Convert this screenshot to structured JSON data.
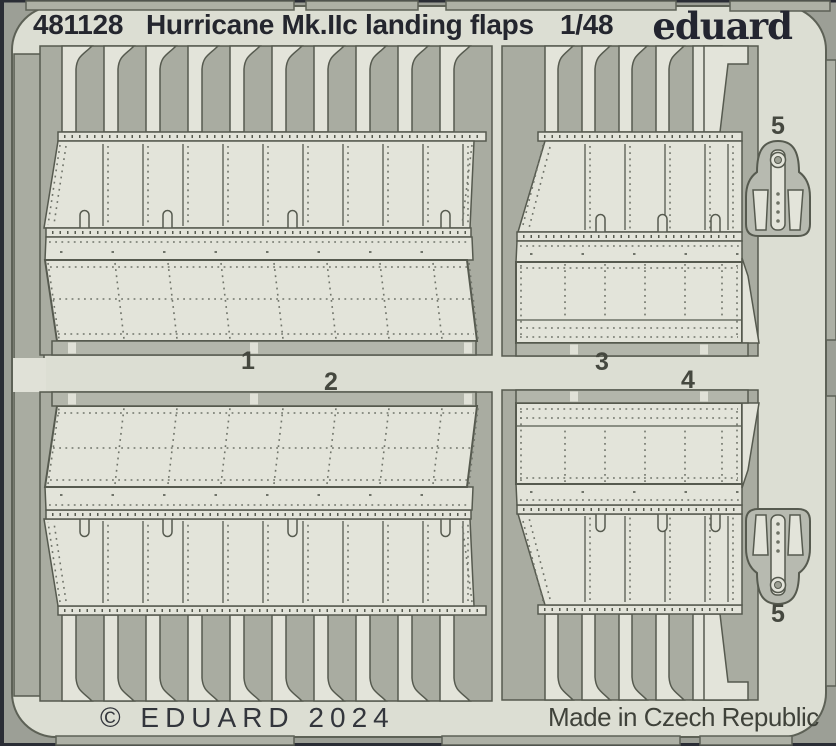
{
  "product": {
    "code": "481128",
    "name": "Hurricane Mk.IIc  landing flaps",
    "scale": "1/48",
    "brand_logo": "eduard"
  },
  "footer": {
    "copyright": "© EDUARD 2024",
    "made_in": "Made in Czech Republic"
  },
  "part_labels": {
    "p1": "1",
    "p2": "2",
    "p3": "3",
    "p4": "4",
    "p5_top": "5",
    "p5_bottom": "5"
  },
  "colors": {
    "background": "#9c9f96",
    "sheet_metal": "#dcded3",
    "etched_cutout": "#a9aca1",
    "part_surface": "#e3e4da",
    "half_etched": "#b7bab0",
    "outline": "#565a4f",
    "header_text": "#24262e",
    "footer_text": "#3f423a",
    "photo_border": "#2a2d35"
  }
}
